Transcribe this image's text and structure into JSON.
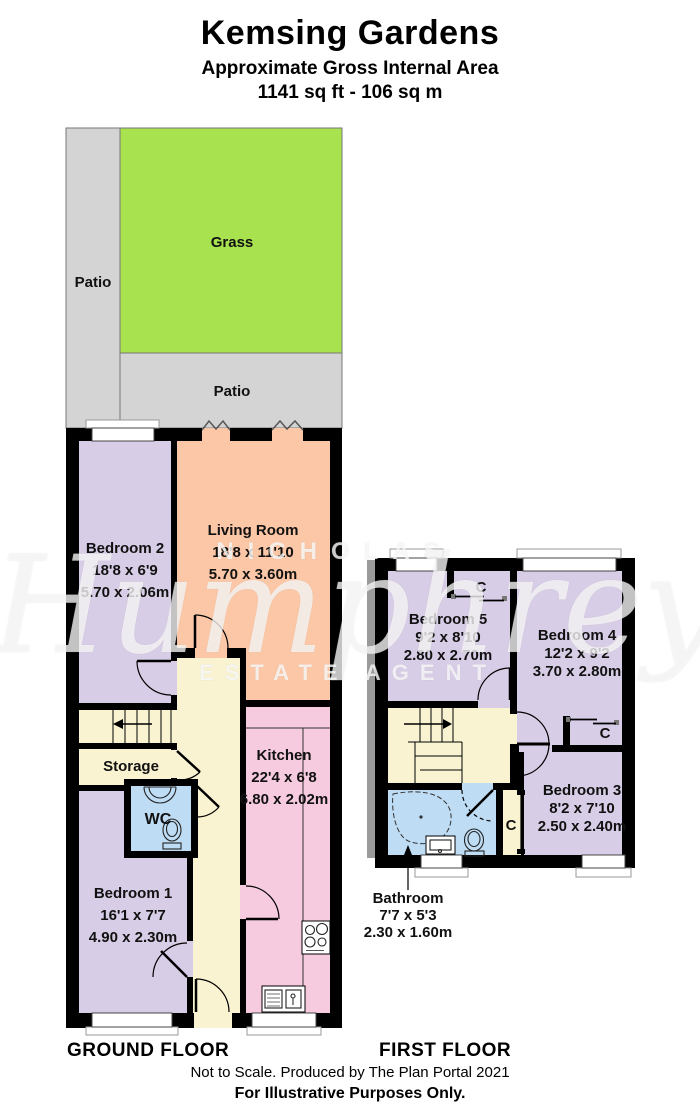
{
  "header": {
    "title": "Kemsing Gardens",
    "subtitle": "Approximate Gross Internal Area",
    "area": "1141 sq ft - 106 sq m"
  },
  "watermark": {
    "line1": "NICHOLAS",
    "script": "Humphreys",
    "line2": "ESTATE AGENT"
  },
  "gf": {
    "floor_label": "GROUND FLOOR",
    "patio_left": "Patio",
    "grass": "Grass",
    "patio_bottom": "Patio",
    "rooms": {
      "bedroom2": {
        "name": "Bedroom 2",
        "ft": "18'8 x 6'9",
        "m": "5.70 x 2.06m"
      },
      "living": {
        "name": "Living Room",
        "ft": "18'8 x 11'10",
        "m": "5.70 x 3.60m"
      },
      "storage": {
        "name": "Storage"
      },
      "wc": {
        "name": "WC"
      },
      "kitchen": {
        "name": "Kitchen",
        "ft": "22'4 x 6'8",
        "m": "6.80 x 2.02m"
      },
      "bedroom1": {
        "name": "Bedroom 1",
        "ft": "16'1 x 7'7",
        "m": "4.90 x 2.30m"
      }
    }
  },
  "ff": {
    "floor_label": "FIRST FLOOR",
    "closet_label": "C",
    "rooms": {
      "bedroom5": {
        "name": "Bedroom 5",
        "ft": "9'2 x 8'10",
        "m": "2.80 x 2.70m"
      },
      "bedroom4": {
        "name": "Bedroom 4",
        "ft": "12'2 x 9'2",
        "m": "3.70 x 2.80m"
      },
      "bedroom3": {
        "name": "Bedroom 3",
        "ft": "8'2 x 7'10",
        "m": "2.50 x 2.40m"
      },
      "bathroom": {
        "name": "Bathroom",
        "ft": "7'7 x 5'3",
        "m": "2.30 x 1.60m"
      }
    }
  },
  "footer": {
    "line1": "Not to Scale. Produced by The Plan Portal 2021",
    "line2": "For Illustrative Purposes Only."
  },
  "colors": {
    "wall": "#000000",
    "patio": "#d4d4d4",
    "grass": "#a8e24f",
    "bedroom": "#d8cde6",
    "living": "#fbc7a6",
    "kitchen": "#f6cbdf",
    "hall": "#f9f3d2",
    "wet_room": "#bedcf4"
  }
}
